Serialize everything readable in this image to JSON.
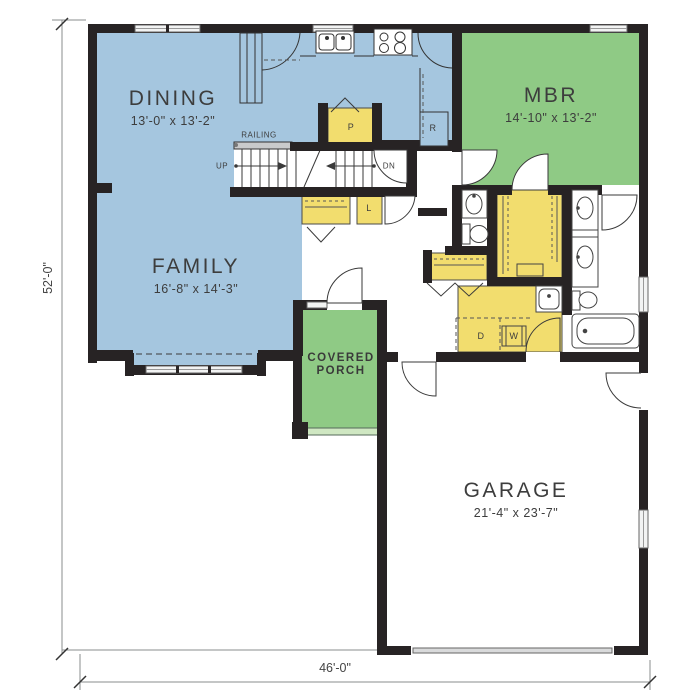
{
  "plan_title": "first-floor-plan",
  "overall_dimensions": {
    "height_left": "52'-0\"",
    "width_bottom": "46'-0\""
  },
  "rooms": {
    "dining": {
      "name": "DINING",
      "size": "13'-0\" x 13'-2\""
    },
    "family": {
      "name": "FAMILY",
      "size": "16'-8\" x 14'-3\""
    },
    "master_bedroom": {
      "name": "MBR",
      "size": "14'-10\" x 13'-2\""
    },
    "garage": {
      "name": "GARAGE",
      "size": "21'-4\" x 23'-7\""
    },
    "covered_porch": {
      "line1": "COVERED",
      "line2": "PORCH"
    }
  },
  "annotations": {
    "railing": "RAILING",
    "stairs_up": "UP",
    "stairs_down": "DN",
    "pantry": "P",
    "linen": "L",
    "refrigerator": "R",
    "dryer": "D",
    "washer": "W"
  },
  "colors": {
    "living_blue": "#a5c6df",
    "bedroom_porch_green": "#8fca85",
    "storage_yellow": "#f2dd6e",
    "wall_black": "#272324",
    "porch_step_green": "#cfe7c2",
    "window_gray": "#f2f3f3",
    "garage_door_gray": "#d9dadb"
  }
}
